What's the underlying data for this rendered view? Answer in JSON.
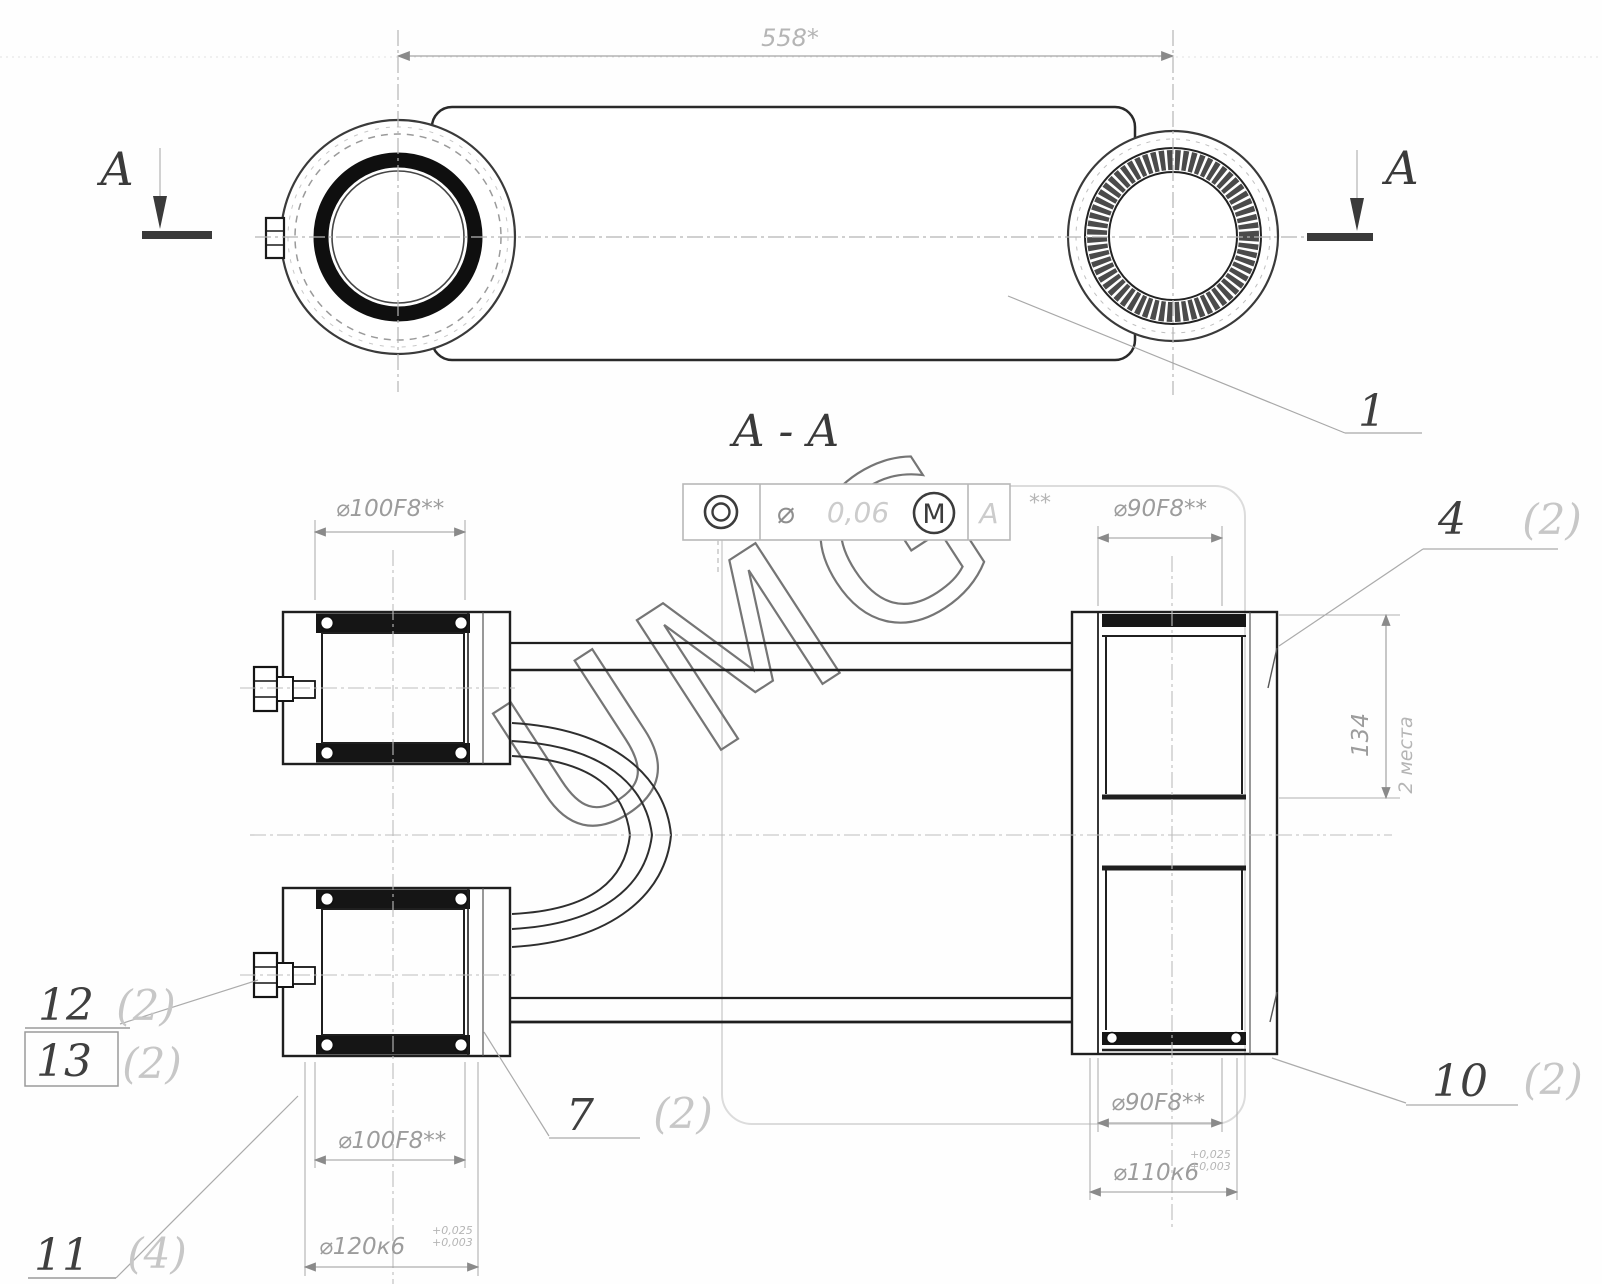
{
  "watermark": "UMG",
  "top_view": {
    "dim_length": "558*",
    "section_left": "A",
    "section_right": "A",
    "section_label": "A - A",
    "callout_1": "1"
  },
  "tolerance_frame": {
    "symbol": "concentricity",
    "diameter": "⌀",
    "value": "0,06",
    "modifier": "M",
    "datum": "A",
    "suffix": "**"
  },
  "dims": {
    "left_bore_top": "⌀100F8**",
    "right_bore_top": "⌀90F8**",
    "left_bore_bottom": "⌀100F8**",
    "left_od": "⌀120к6",
    "left_od_tol_hi": "+0,025",
    "left_od_tol_lo": "+0,003",
    "right_bore_bottom": "⌀90F8**",
    "right_od": "⌀110к6",
    "right_od_tol_hi": "+0,025",
    "right_od_tol_lo": "+0,003",
    "depth": "134",
    "depth_note": "2 места"
  },
  "callouts": {
    "c4": {
      "num": "4",
      "qty": "(2)"
    },
    "c7": {
      "num": "7",
      "qty": "(2)"
    },
    "c10": {
      "num": "10",
      "qty": "(2)"
    },
    "c11": {
      "num": "11",
      "qty": "(4)"
    },
    "c12": {
      "num": "12",
      "qty": "(2)"
    },
    "c13": {
      "num": "13",
      "qty": "(2)"
    }
  }
}
